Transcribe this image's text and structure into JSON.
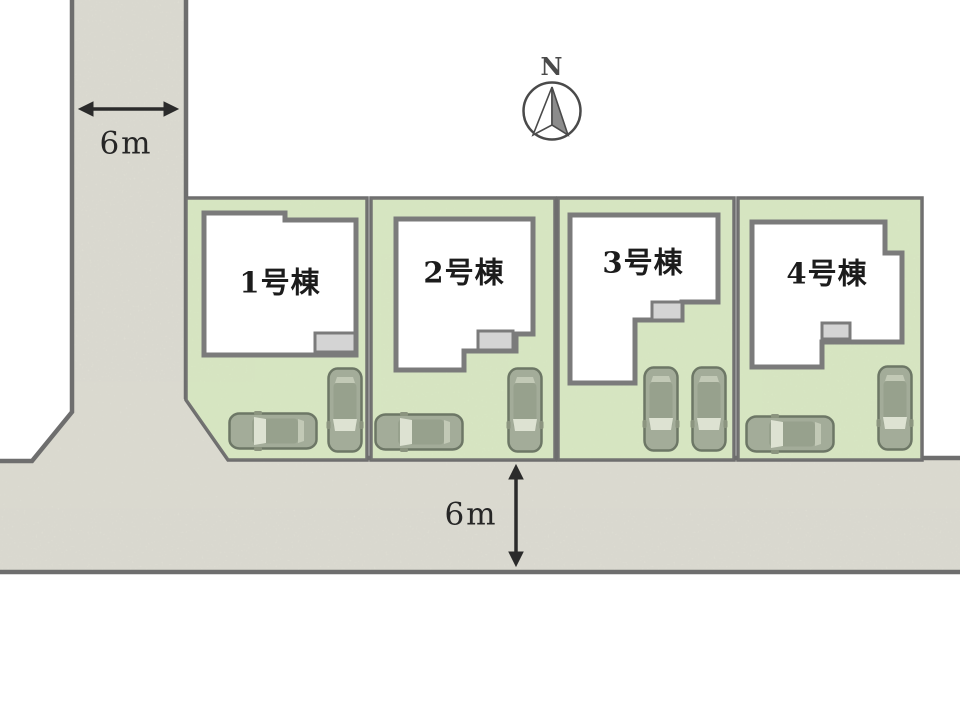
{
  "plan": {
    "title": "4-lot residential site plan",
    "compass": {
      "label": "N"
    },
    "dimensions": {
      "vertical_road_width": "6m",
      "horizontal_road_width": "6m"
    },
    "lots": [
      {
        "id": 1,
        "label": "1号棟",
        "cars": 2
      },
      {
        "id": 2,
        "label": "2号棟",
        "cars": 2
      },
      {
        "id": 3,
        "label": "3号棟",
        "cars": 2
      },
      {
        "id": 4,
        "label": "4号棟",
        "cars": 2
      }
    ],
    "colors": {
      "lot_green": "#dcecc6",
      "road_gray": "#e4e3d9",
      "boundary_line": "#6e6e6e",
      "house_fill": "#ffffff",
      "house_stroke": "#7b7b7b",
      "porch_fill": "#d4d4d4",
      "car_body": "#a3ac99",
      "car_glass": "#dde2d2",
      "text": "#1c1c1c"
    }
  }
}
